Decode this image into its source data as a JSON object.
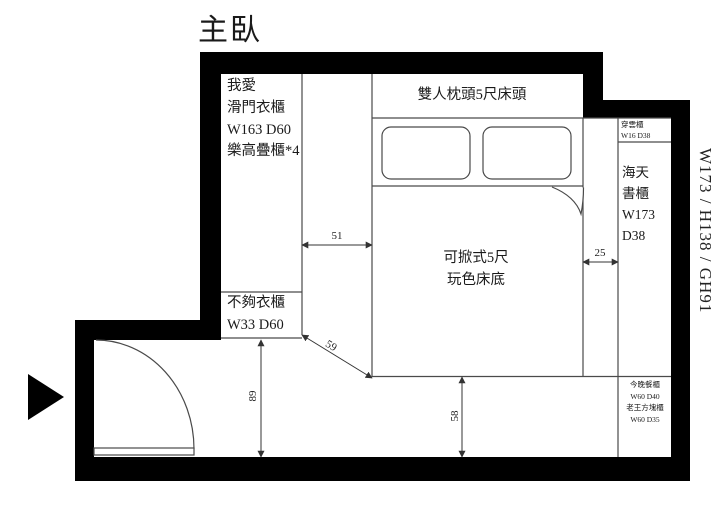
{
  "title": "主臥",
  "labels": {
    "wardrobe": "我愛\n滑門衣櫃\nW163 D60\n樂高疊櫃*4",
    "headboard": "雙人枕頭5尺床頭",
    "window_cabinet": "穿雲櫃\nW16 D38",
    "bookcase": "海天\n書櫃\nW173\nD38",
    "bed": "可掀式5尺\n玩色床底",
    "small_wardrobe": "不夠衣櫃\nW33 D60",
    "side_cabinets": "今晚餐櫃\nW60 D40\n老王方塊櫃\nW60 D35",
    "wall_spec": "W173 / H138 / GH91"
  },
  "dimensions_cm": {
    "closet_to_bed": "51",
    "bed_to_bookcase": "25",
    "diagonal_clearance": "59",
    "door_zone_depth": "89",
    "bed_to_wall": "58"
  },
  "colors": {
    "wall": "#000000",
    "furniture_line": "#4a4a4a",
    "dimension_line": "#333333"
  }
}
